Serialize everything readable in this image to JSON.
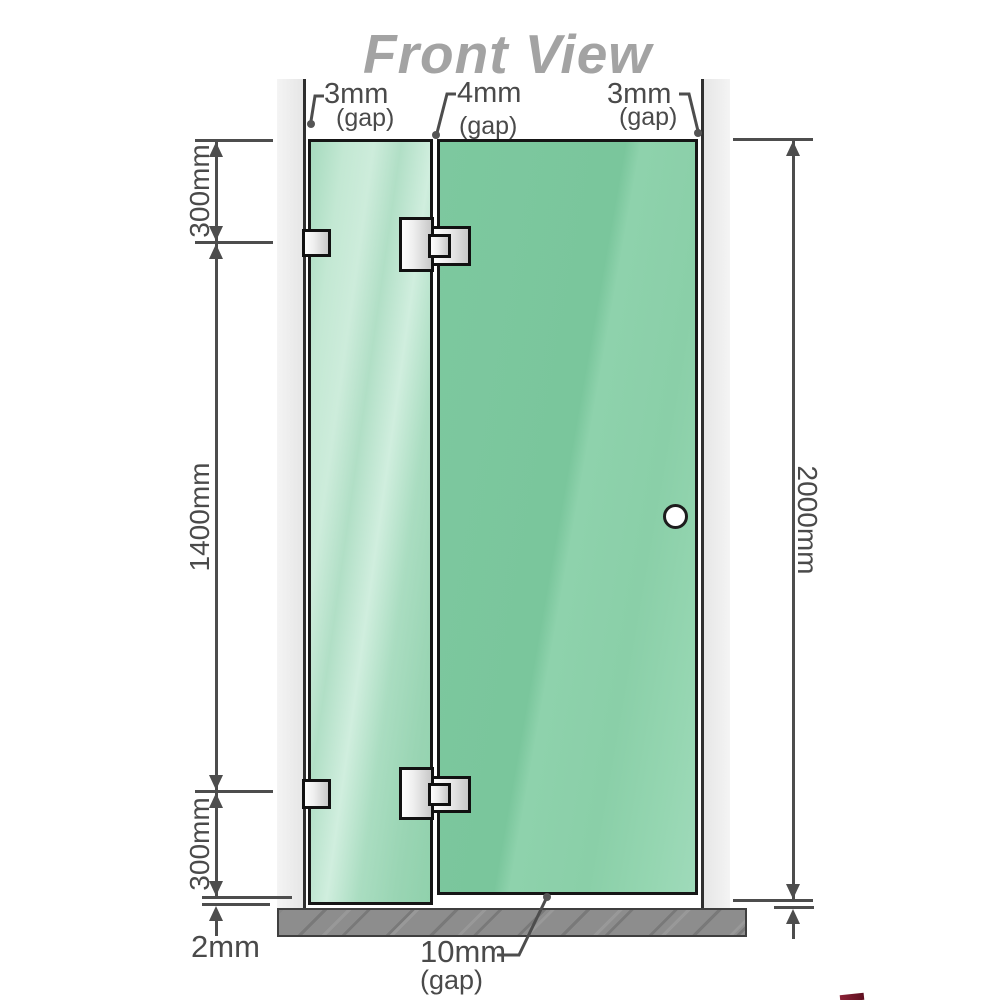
{
  "title": "Front View",
  "gaps": {
    "top_left": {
      "value": "3mm",
      "suffix": "(gap)"
    },
    "top_middle": {
      "value": "4mm",
      "suffix": "(gap)"
    },
    "top_right": {
      "value": "3mm",
      "suffix": "(gap)"
    },
    "bottom_door": {
      "value": "10mm",
      "suffix": "(gap)"
    },
    "bottom_panel": {
      "value": "2mm"
    }
  },
  "dimensions": {
    "left_top": "300mm",
    "left_middle": "1400mm",
    "left_bottom": "300mm",
    "right_overall": "2000mm"
  },
  "colors": {
    "door_glass": "#7cc79e",
    "fixed_panel_glass": "#b5e0c8",
    "wall_channel": "#ececec",
    "floor": "#8d8d8d",
    "dimension_lines": "#4d4d4d",
    "title_text": "#a3a3a3",
    "hardware_silver": "#e6e6e6"
  }
}
